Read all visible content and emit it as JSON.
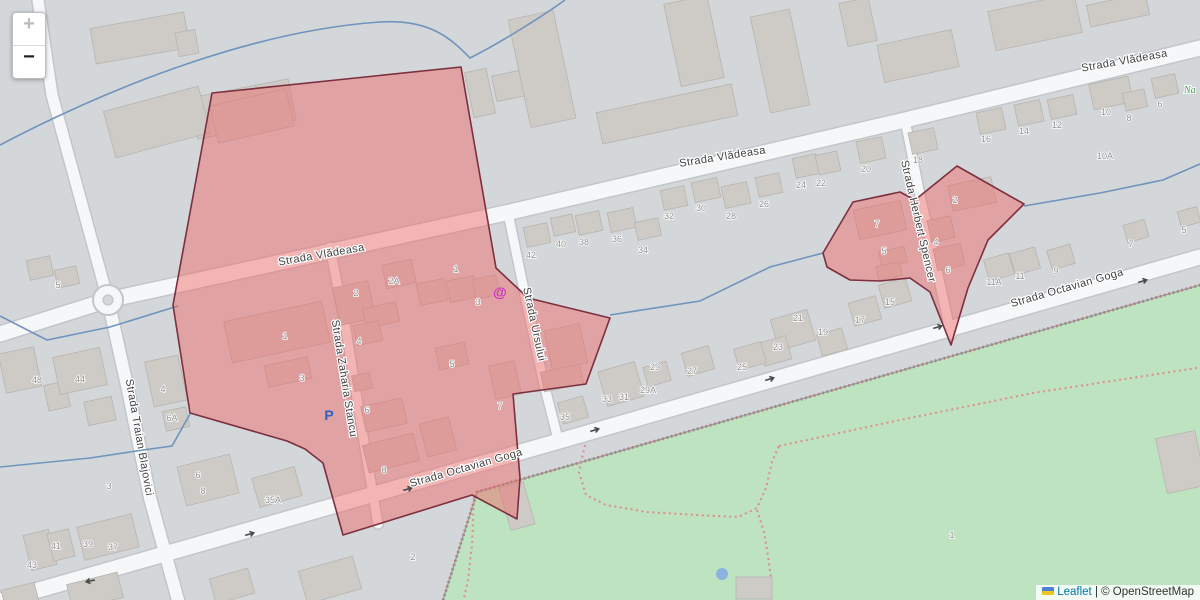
{
  "controls": {
    "zoom_in_label": "+",
    "zoom_out_label": "−"
  },
  "attribution": {
    "leaflet_label": "Leaflet",
    "separator": "|",
    "osm_label": "© OpenStreetMap"
  },
  "map": {
    "colors": {
      "bg": "#d3d7d9",
      "road_fill": "#f6f7f8",
      "road_casing": "#c2c6ca",
      "building_fill": "#cecbc7",
      "building_stroke": "#b7b4b0",
      "stream": "#6f94bd",
      "park": "#bee3c1",
      "park_edge": "#979da0",
      "barrier": "#b07d7d",
      "path_dash": "#e08c8c",
      "overlay_fill": "rgba(240,100,100,0.46)",
      "overlay_stroke": "#7d2f3f",
      "label": "#3f3f3f",
      "number": "#8f8f8f",
      "parking_blue": "#2f62c4",
      "at_magenta": "#cc2fc4",
      "green_text": "#3f9e53",
      "arrow": "#4a4a4a",
      "pond": "#8ab4e0"
    },
    "park": {
      "outline": "443,600 477,492 1200,285 1200,600",
      "edge_path": "M 443,600 L 477,492 L 1200,285",
      "pond": {
        "x": 722,
        "y": 574,
        "r": 6
      }
    },
    "roads": [
      {
        "name": "strada-vladeasa",
        "d": "M 0,334 L 108,300 L 510,212 L 905,120 L 1200,48",
        "w": 15
      },
      {
        "name": "northwest-road",
        "d": "M 38,0 L 52,95 L 108,300",
        "w": 11
      },
      {
        "name": "strada-traian-blajovici",
        "d": "M 108,300 L 128,390 L 150,498 L 178,600",
        "w": 12
      },
      {
        "name": "strada-octavian-goga",
        "d": "M 0,601 L 413,483 L 1067,295 L 1200,257",
        "w": 15
      },
      {
        "name": "strada-zaharia-stancu",
        "d": "M 330,247 L 346,330 L 362,430 L 378,524",
        "w": 9
      },
      {
        "name": "strada-ursului",
        "d": "M 508,213 L 526,300 L 543,380 L 559,443",
        "w": 9
      },
      {
        "name": "strada-herbert-spencer",
        "d": "M 905,120 L 921,200 L 937,270 L 951,335",
        "w": 9
      }
    ],
    "roundabout": {
      "x": 108,
      "y": 300,
      "r": 15
    },
    "buildings": [
      [
        140,
        38,
        95,
        36,
        -10
      ],
      [
        187,
        43,
        20,
        24,
        -10
      ],
      [
        243,
        109,
        100,
        42,
        -11
      ],
      [
        157,
        122,
        98,
        48,
        -15
      ],
      [
        480,
        93,
        22,
        46,
        -12
      ],
      [
        508,
        86,
        28,
        26,
        -12
      ],
      [
        542,
        69,
        46,
        110,
        -12
      ],
      [
        694,
        41,
        44,
        84,
        -12
      ],
      [
        780,
        61,
        40,
        98,
        -12
      ],
      [
        667,
        114,
        138,
        32,
        -12
      ],
      [
        858,
        22,
        30,
        44,
        -12
      ],
      [
        918,
        56,
        76,
        38,
        -12
      ],
      [
        1035,
        22,
        88,
        40,
        -12
      ],
      [
        1118,
        10,
        60,
        22,
        -12
      ],
      [
        40,
        268,
        24,
        20,
        -12
      ],
      [
        67,
        277,
        22,
        18,
        -12
      ],
      [
        20,
        370,
        36,
        40,
        -12
      ],
      [
        57,
        396,
        22,
        26,
        -12
      ],
      [
        80,
        371,
        48,
        38,
        -12
      ],
      [
        100,
        411,
        28,
        24,
        -12
      ],
      [
        166,
        381,
        34,
        46,
        -12
      ],
      [
        176,
        419,
        24,
        20,
        -12
      ],
      [
        208,
        480,
        54,
        40,
        -14
      ],
      [
        40,
        550,
        26,
        36,
        -14
      ],
      [
        61,
        545,
        22,
        28,
        -14
      ],
      [
        108,
        537,
        56,
        34,
        -14
      ],
      [
        95,
        591,
        52,
        26,
        -14
      ],
      [
        20,
        596,
        34,
        20,
        -14
      ],
      [
        252,
        116,
        78,
        38,
        -13
      ],
      [
        277,
        332,
        100,
        42,
        -12
      ],
      [
        288,
        372,
        44,
        22,
        -12
      ],
      [
        354,
        303,
        36,
        38,
        -12
      ],
      [
        381,
        315,
        34,
        20,
        -12
      ],
      [
        368,
        333,
        26,
        20,
        -12
      ],
      [
        399,
        274,
        30,
        24,
        -12
      ],
      [
        432,
        292,
        28,
        22,
        -12
      ],
      [
        462,
        289,
        28,
        22,
        -12
      ],
      [
        486,
        287,
        24,
        20,
        -12
      ],
      [
        452,
        356,
        30,
        22,
        -12
      ],
      [
        362,
        382,
        18,
        16,
        -12
      ],
      [
        384,
        415,
        42,
        26,
        -12
      ],
      [
        505,
        380,
        26,
        34,
        -12
      ],
      [
        391,
        453,
        52,
        28,
        -14
      ],
      [
        438,
        437,
        30,
        34,
        -14
      ],
      [
        566,
        347,
        36,
        40,
        -12
      ],
      [
        562,
        378,
        40,
        20,
        -12
      ],
      [
        537,
        235,
        24,
        20,
        -12
      ],
      [
        563,
        225,
        22,
        18,
        -12
      ],
      [
        589,
        223,
        24,
        20,
        -12
      ],
      [
        622,
        220,
        26,
        20,
        -12
      ],
      [
        648,
        229,
        24,
        18,
        -12
      ],
      [
        674,
        198,
        24,
        20,
        -12
      ],
      [
        706,
        190,
        26,
        20,
        -12
      ],
      [
        736,
        195,
        26,
        22,
        -12
      ],
      [
        769,
        185,
        24,
        20,
        -12
      ],
      [
        806,
        166,
        24,
        20,
        -12
      ],
      [
        828,
        163,
        22,
        20,
        -12
      ],
      [
        871,
        150,
        26,
        22,
        -12
      ],
      [
        923,
        141,
        26,
        22,
        -12
      ],
      [
        991,
        121,
        26,
        22,
        -12
      ],
      [
        1029,
        113,
        26,
        22,
        -12
      ],
      [
        1062,
        107,
        26,
        20,
        -12
      ],
      [
        1111,
        93,
        40,
        26,
        -12
      ],
      [
        1135,
        100,
        22,
        18,
        -12
      ],
      [
        1165,
        86,
        24,
        20,
        -12
      ],
      [
        1061,
        257,
        24,
        20,
        -16
      ],
      [
        1025,
        261,
        26,
        22,
        -16
      ],
      [
        999,
        267,
        26,
        22,
        -16
      ],
      [
        895,
        293,
        28,
        24,
        -16
      ],
      [
        865,
        311,
        28,
        24,
        -16
      ],
      [
        832,
        342,
        26,
        22,
        -16
      ],
      [
        793,
        330,
        38,
        32,
        -16
      ],
      [
        775,
        351,
        28,
        24,
        -16
      ],
      [
        750,
        356,
        28,
        22,
        -16
      ],
      [
        698,
        361,
        28,
        24,
        -16
      ],
      [
        657,
        374,
        24,
        20,
        -16
      ],
      [
        621,
        384,
        38,
        36,
        -16
      ],
      [
        573,
        410,
        26,
        22,
        -16
      ],
      [
        277,
        487,
        44,
        30,
        -16
      ],
      [
        1136,
        231,
        22,
        18,
        -16
      ],
      [
        1189,
        217,
        20,
        16,
        -16
      ],
      [
        880,
        220,
        48,
        30,
        -12
      ],
      [
        893,
        257,
        26,
        16,
        -12
      ],
      [
        889,
        271,
        24,
        14,
        -12
      ],
      [
        972,
        194,
        44,
        26,
        -12
      ],
      [
        941,
        229,
        24,
        22,
        -12
      ],
      [
        949,
        257,
        28,
        22,
        -12
      ],
      [
        330,
        580,
        56,
        34,
        -16
      ],
      [
        232,
        586,
        40,
        26,
        -16
      ],
      [
        517,
        506,
        25,
        44,
        -16
      ],
      [
        754,
        588,
        36,
        22,
        0
      ],
      [
        1181,
        462,
        40,
        56,
        -12
      ]
    ],
    "streams": [
      "M 0,145 C 120,82 260,30 380,22 C 432,19 452,40 470,58 C 498,44 540,18 565,0",
      "M 0,316 L 47,340 L 110,327 L 178,306",
      "M 0,467 L 90,458 L 143,450 L 172,446 L 190,414",
      "M 610,315 L 700,301 L 770,267 L 823,253",
      "M 1024,206 L 1100,193 L 1163,180 L 1200,164"
    ],
    "park_paths": [
      "M 585,445 L 579,472 L 586,495 L 606,505 L 647,512 L 697,515 L 738,517 L 757,508 L 766,488 L 772,462 L 779,446",
      "M 757,510 L 764,532 L 768,556 L 771,578",
      "M 779,446 L 900,420 L 1033,393 L 1197,368",
      "M 474,497 L 472,545 L 468,580 L 464,598"
    ],
    "overlays": [
      {
        "name": "highlight-area-west",
        "points": "212,93 461,67 496,268 528,298 610,318 586,384 513,394 520,478 517,519 472,495 343,535 323,463 305,449 287,441 190,413 173,305"
      },
      {
        "name": "highlight-area-east",
        "points": "823,253 853,202 900,192 915,200 957,166 1024,204 988,240 968,288 951,345 930,292 910,278 880,281 850,280 827,267"
      }
    ],
    "street_labels": [
      {
        "t": "Strada Vlădeasa",
        "x": 322,
        "y": 258,
        "r": -10
      },
      {
        "t": "Strada Vlădeasa",
        "x": 723,
        "y": 160,
        "r": -9
      },
      {
        "t": "Strada Vlădeasa",
        "x": 1125,
        "y": 64,
        "r": -10
      },
      {
        "t": "Strada Zaharia Stancu",
        "x": 341,
        "y": 379,
        "r": 81
      },
      {
        "t": "Strada Ursului",
        "x": 531,
        "y": 325,
        "r": 78
      },
      {
        "t": "Strada Herbert Spencer",
        "x": 915,
        "y": 222,
        "r": 77
      },
      {
        "t": "Strada Traian Blajovici",
        "x": 136,
        "y": 438,
        "r": 80
      },
      {
        "t": "Strada Octavian Goga",
        "x": 467,
        "y": 471,
        "r": -16
      },
      {
        "t": "Strada Octavian Goga",
        "x": 1068,
        "y": 291,
        "r": -16
      }
    ],
    "house_numbers": [
      [
        "42",
        531,
        258
      ],
      [
        "40",
        561,
        247
      ],
      [
        "38",
        584,
        245
      ],
      [
        "36",
        617,
        242
      ],
      [
        "34",
        643,
        253
      ],
      [
        "32",
        669,
        219
      ],
      [
        "30",
        701,
        211
      ],
      [
        "28",
        731,
        219
      ],
      [
        "26",
        764,
        207
      ],
      [
        "24",
        801,
        188
      ],
      [
        "22",
        821,
        186
      ],
      [
        "20",
        866,
        172
      ],
      [
        "18",
        918,
        163
      ],
      [
        "16",
        986,
        142
      ],
      [
        "14",
        1024,
        134
      ],
      [
        "12",
        1057,
        128
      ],
      [
        "10",
        1106,
        115
      ],
      [
        "8",
        1129,
        121
      ],
      [
        "6",
        1160,
        107
      ],
      [
        "10A",
        1105,
        159
      ],
      [
        "5",
        58,
        288
      ],
      [
        "48",
        37,
        383
      ],
      [
        "44",
        80,
        382
      ],
      [
        "4",
        163,
        392
      ],
      [
        "6A",
        172,
        421
      ],
      [
        "3",
        109,
        489
      ],
      [
        "6",
        198,
        478
      ],
      [
        "8",
        203,
        494
      ],
      [
        "43",
        32,
        568
      ],
      [
        "41",
        56,
        549
      ],
      [
        "39",
        88,
        547
      ],
      [
        "37",
        113,
        550
      ],
      [
        "1",
        285,
        339
      ],
      [
        "3",
        302,
        381
      ],
      [
        "2",
        356,
        296
      ],
      [
        "2A",
        394,
        284
      ],
      [
        "1",
        456,
        272
      ],
      [
        "3",
        478,
        305
      ],
      [
        "4",
        359,
        344
      ],
      [
        "5",
        452,
        367
      ],
      [
        "6",
        367,
        413
      ],
      [
        "7",
        500,
        409
      ],
      [
        "8",
        384,
        473
      ],
      [
        "35A",
        273,
        503
      ],
      [
        "35",
        565,
        420
      ],
      [
        "33",
        607,
        402
      ],
      [
        "31",
        624,
        400
      ],
      [
        "29A",
        648,
        393
      ],
      [
        "29",
        655,
        370
      ],
      [
        "27",
        692,
        374
      ],
      [
        "25",
        742,
        370
      ],
      [
        "23",
        778,
        350
      ],
      [
        "21",
        798,
        321
      ],
      [
        "19",
        823,
        335
      ],
      [
        "17",
        860,
        323
      ],
      [
        "15",
        890,
        305
      ],
      [
        "11A",
        994,
        285
      ],
      [
        "11",
        1020,
        279
      ],
      [
        "9",
        1056,
        274
      ],
      [
        "7",
        1131,
        247
      ],
      [
        "5",
        1184,
        233
      ],
      [
        "7",
        877,
        227
      ],
      [
        "5",
        884,
        254
      ],
      [
        "2",
        955,
        203
      ],
      [
        "4",
        936,
        245
      ],
      [
        "6",
        948,
        273
      ],
      [
        "1",
        952,
        538
      ],
      [
        "2",
        413,
        560
      ]
    ],
    "arrows": [
      [
        90,
        581,
        168
      ],
      [
        250,
        534,
        -16
      ],
      [
        408,
        489,
        -16
      ],
      [
        595,
        430,
        -16
      ],
      [
        770,
        379,
        -16
      ],
      [
        938,
        327,
        -16
      ],
      [
        1143,
        281,
        -16
      ]
    ],
    "icons": {
      "parking": {
        "t": "P",
        "x": 329,
        "y": 420
      },
      "internet": {
        "t": "@",
        "x": 500,
        "y": 297
      },
      "park_name": {
        "t": "Na",
        "x": 1184,
        "y": 93
      }
    }
  }
}
